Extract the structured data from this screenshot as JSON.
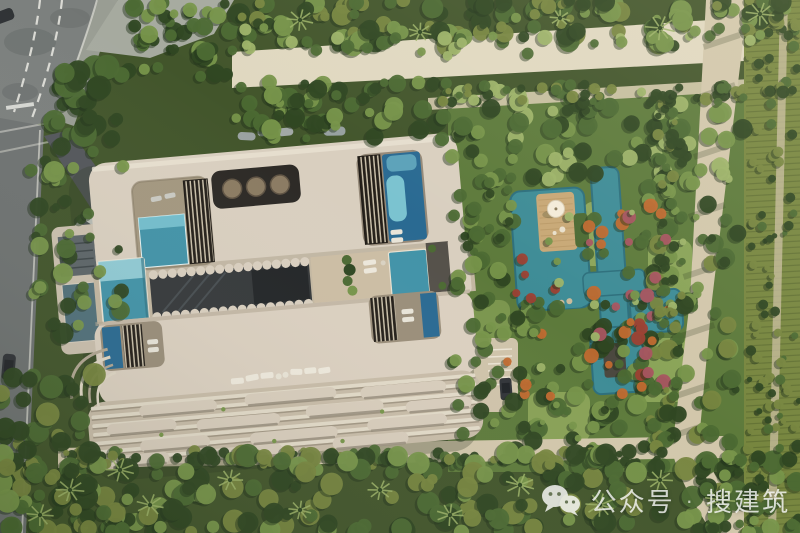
{
  "watermark": {
    "label": "公众号",
    "separator": "·",
    "brand": "搜建筑",
    "color": "#ffffff",
    "opacity": 0.78,
    "icon": "wechat-icon"
  },
  "scene": {
    "view": "top-down aerial architectural render",
    "subject": "Beige curved building with rooftop courtyards and pools, scalloped balcony terraces, water garden with teal ponds, sun deck with parasol, roads, sand paths, hedgerows and dense tree canopy",
    "regions": [
      "road",
      "driveway",
      "building-roof",
      "courtyard-pools",
      "skylight-panel",
      "lap-pool",
      "atrium",
      "balcony-terraces",
      "water-garden",
      "ponds",
      "sun-deck",
      "sand-paths",
      "hedgerows",
      "tree-canopy"
    ],
    "vehicles": [
      "white-car-on-driveway",
      "dark-car-on-road",
      "dark-car-parked"
    ]
  },
  "palette": {
    "asphalt": "#7b7f7d",
    "asphalt_dark": "#6e7271",
    "driveway": "#53565a",
    "concrete": "#a6aa9f",
    "sidewalk": "#999d93",
    "road_marking": "#e4e4de",
    "sand_path": "#d2c7ab",
    "sand_light": "#e0d8c0",
    "building_beige": "#d9cfbf",
    "building_light": "#e9e1d2",
    "building_shade": "#b2a792",
    "recess_ground": "#a3977f",
    "louver_dark": "#241f19",
    "glass_dark": "#35383a",
    "glass_light": "#5d686d",
    "skylight_panel": "#2c2925",
    "skylight_circle": "#8b7b62",
    "pool_teal": "#4293a8",
    "pool_light": "#7fc8d4",
    "pool_deep": "#2a6a92",
    "pond_teal": "#3e8c96",
    "pond_dark": "#2d6f7c",
    "deck_tan": "#c8a876",
    "grass_light": "#8fa85c",
    "green_shadow": "#22331a",
    "green_dark": "#2f4722",
    "green_mid": "#4c6a33",
    "green_bright": "#77954a",
    "green_pale": "#9db368",
    "olive": "#77863f",
    "flower_orange": "#c06a2f",
    "flower_red": "#9c4133",
    "flower_pink": "#a85560",
    "car_white": "#eceeea",
    "car_dark": "#313438"
  }
}
